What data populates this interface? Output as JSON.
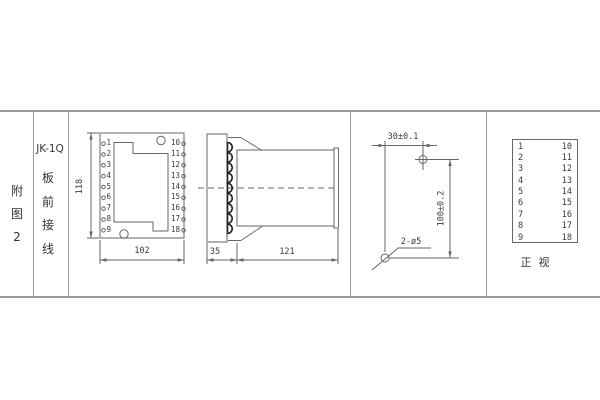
{
  "sidebar": {
    "figure_chars": [
      "附",
      "图",
      "2"
    ]
  },
  "title_block": {
    "model": "JK-1Q",
    "wiring_chars": [
      "板",
      "前",
      "接",
      "线"
    ]
  },
  "front_view": {
    "terminals_left": [
      "1",
      "2",
      "3",
      "4",
      "5",
      "6",
      "7",
      "8",
      "9"
    ],
    "terminals_right": [
      "10",
      "11",
      "12",
      "13",
      "14",
      "15",
      "16",
      "17",
      "18"
    ],
    "dim_height": "118",
    "dim_width": "102"
  },
  "side_view": {
    "dim_plate_depth": "35",
    "dim_body_depth": "121"
  },
  "drill_plan": {
    "dim_horizontal": "30±0.1",
    "dim_vertical": "100±0.2",
    "holes_label": "2-ø5"
  },
  "terminal_table": {
    "col_left": [
      "1",
      "2",
      "3",
      "4",
      "5",
      "6",
      "7",
      "8",
      "9"
    ],
    "col_right": [
      "10",
      "11",
      "12",
      "13",
      "14",
      "15",
      "16",
      "17",
      "18"
    ],
    "caption": "正  视"
  },
  "colors": {
    "drawing_line": "#666666",
    "frame_line": "#9a9a9a",
    "text": "#3a3a3a",
    "terminal_dark": "#222222",
    "background": "#ffffff"
  }
}
